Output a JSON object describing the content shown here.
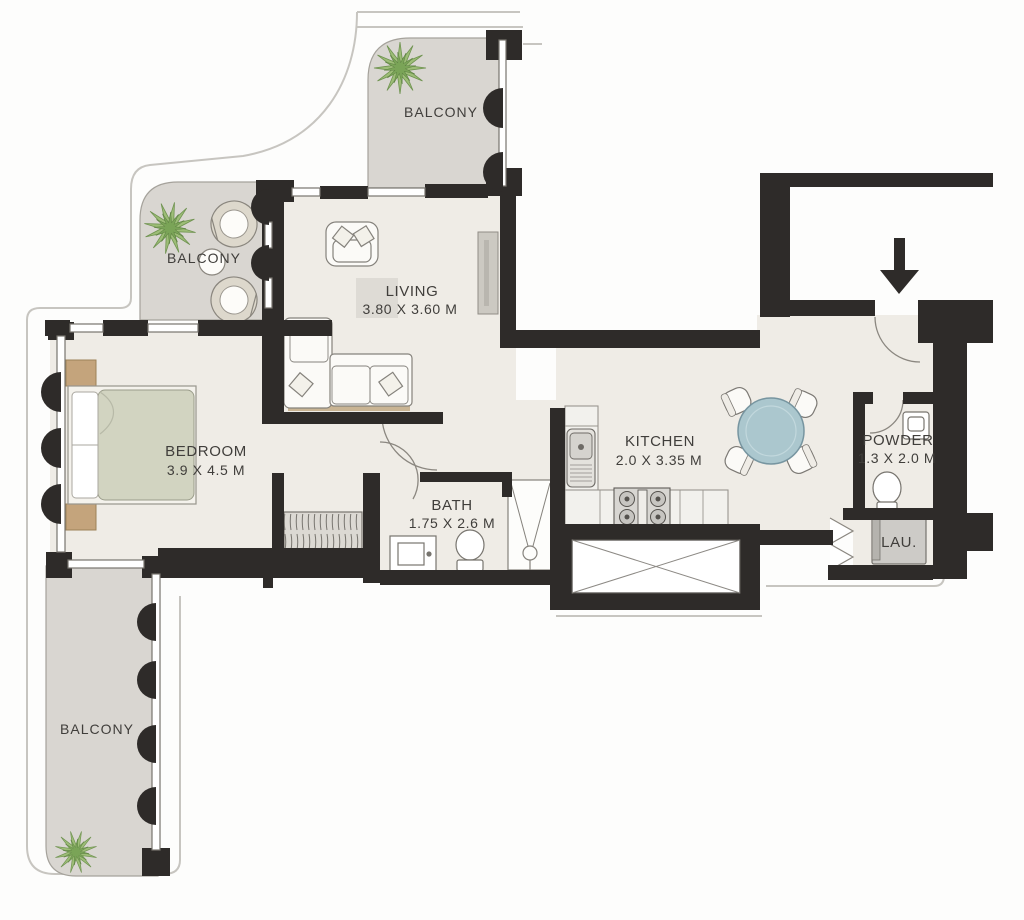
{
  "floor_plan": {
    "rooms": {
      "balcony_top": {
        "label": "BALCONY"
      },
      "balcony_left": {
        "label": "BALCONY"
      },
      "balcony_bottom": {
        "label": "BALCONY"
      },
      "living": {
        "label": "LIVING",
        "dimensions": "3.80 X 3.60 M"
      },
      "bedroom": {
        "label": "BEDROOM",
        "dimensions": "3.9 X 4.5 M"
      },
      "bath": {
        "label": "BATH",
        "dimensions": "1.75 X 2.6 M"
      },
      "kitchen": {
        "label": "KITCHEN",
        "dimensions": "2.0 X 3.35 M"
      },
      "powder": {
        "label": "POWDER",
        "dimensions": "1.3 X 2.0 M"
      },
      "laundry": {
        "label": "LAU."
      }
    },
    "colors": {
      "wall": "#2e2b29",
      "balcony_floor": "#d9d6d1",
      "interior_floor": "#efece6",
      "table_top": "#abc7ce",
      "bed_mattress": "#d2d4c1",
      "nightstand": "#c4a47c",
      "plant": "#8fb56c",
      "background": "#fdfdfc"
    }
  }
}
